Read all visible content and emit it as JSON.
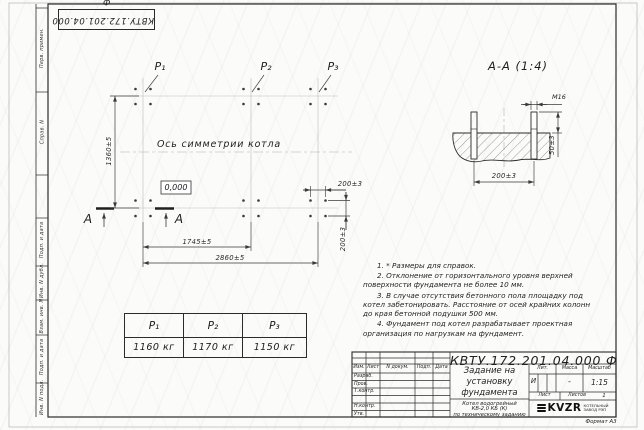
{
  "sheet": {
    "doc_number": "КВТУ.172.201.04.000 Ф",
    "format_label": "Формат А3"
  },
  "margin_labels": {
    "top": [
      "Перв. примен.",
      "Справ. N"
    ],
    "bottom": [
      "Подп. и дата",
      "Инв. N дубл.",
      "Взам. инв. N",
      "Подп. и дата",
      "Инв. N подл."
    ]
  },
  "plan": {
    "symmetry_label": "Ось симметрии котла",
    "level_mark": "0,000",
    "p_labels": [
      "Р₁",
      "Р₂",
      "Р₃"
    ],
    "section_letter": "А",
    "dim_height": "1360±5",
    "dim_span1": "1745±5",
    "dim_total": "2860±5",
    "dim_bolt_h": "200±3",
    "dim_bolt_v": "200±3"
  },
  "section_view": {
    "title": "А-А (1:4)",
    "thread_label": "М16",
    "dim_embed": "50±3",
    "dim_spacing": "200±3"
  },
  "loads_table": {
    "headers": [
      "Р₁",
      "Р₂",
      "Р₃"
    ],
    "values": [
      "1160 кг",
      "1170 кг",
      "1150 кг"
    ]
  },
  "notes": [
    "1. * Размеры для справок.",
    "2. Отклонение от горизонтального уровня верхней поверхности фундамента не более 10 мм.",
    "3. В случае отсутствия бетонного пола площадку под котел забетонировать. Расстояние от осей крайних колонн до края бетонной подушки 500 мм.",
    "4. Фундамент под котел разрабатывает проектная организация по нагрузкам на фундамент."
  ],
  "title_block": {
    "doc_number": "КВТУ.172.201.04.000 Ф",
    "title_lines": [
      "Задание на",
      "установку",
      "фундамента"
    ],
    "product_lines": [
      "Котел водогрейный",
      "КВ-2,0 КБ (К)",
      "по техническому заданию"
    ],
    "header_cols": [
      "Изм.",
      "Лист",
      "N докум.",
      "Подп.",
      "Дата"
    ],
    "sig_rows": [
      "Разраб.",
      "Пров.",
      "Т.контр.",
      "Н.контр.",
      "Утв."
    ],
    "lit_headers": [
      "Лит.",
      "Масса",
      "Масштаб"
    ],
    "lit_values": [
      "И",
      "-",
      "1:15"
    ],
    "sheet_label": "Лист",
    "sheets_label": "Листов",
    "sheets_value": "1",
    "logo_text": "KVZR",
    "logo_org_lines": [
      "КОТЕЛЬНЫЙ",
      "ЗАВОД РЭП"
    ]
  },
  "colors": {
    "object_line": "#2b2b2b",
    "dim_line": "#3a3a3a",
    "axis_line": "#bdbdb9",
    "paper": "#fbfbf9"
  }
}
